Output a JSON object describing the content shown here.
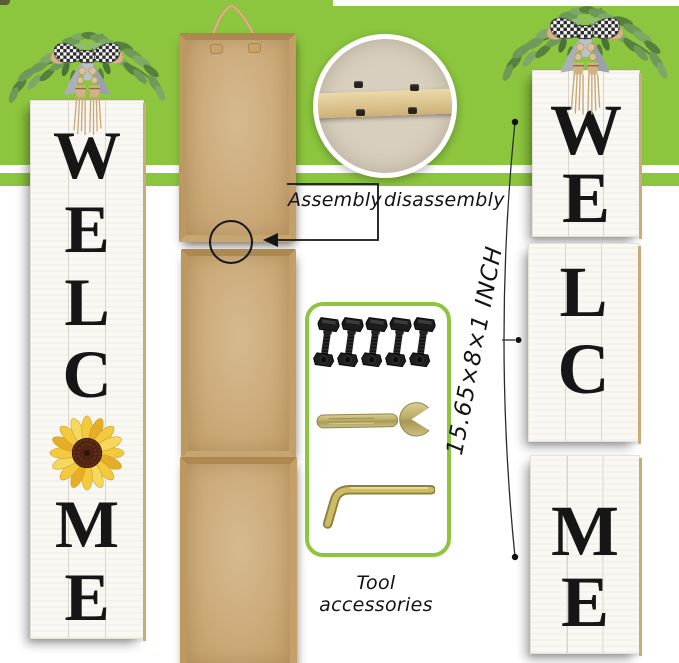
{
  "callouts": {
    "assembly_label": "Assembly",
    "disassembly_label": "disassembly",
    "dimension_label": "15.65×8×1 INCH",
    "tools_label": "Tool accessories"
  },
  "left_sign": {
    "letters": [
      "W",
      "E",
      "L",
      "C",
      "M",
      "E"
    ]
  },
  "right_panels": [
    {
      "letters": [
        "W",
        "E"
      ]
    },
    {
      "letters": [
        "L",
        "C"
      ]
    },
    {
      "letters": [
        "M",
        "E"
      ]
    }
  ],
  "hardware": {
    "bolt_count": 5,
    "items": [
      "bolt",
      "open-end-wrench",
      "hex-key"
    ]
  },
  "colors": {
    "accent_green": "#8cc63e",
    "board_wood": "#ccab7b",
    "board_frame": "#c49e63",
    "brass": "#c4ad52",
    "sunflower_yellow": "#f0c438",
    "letter_black": "#161616"
  }
}
